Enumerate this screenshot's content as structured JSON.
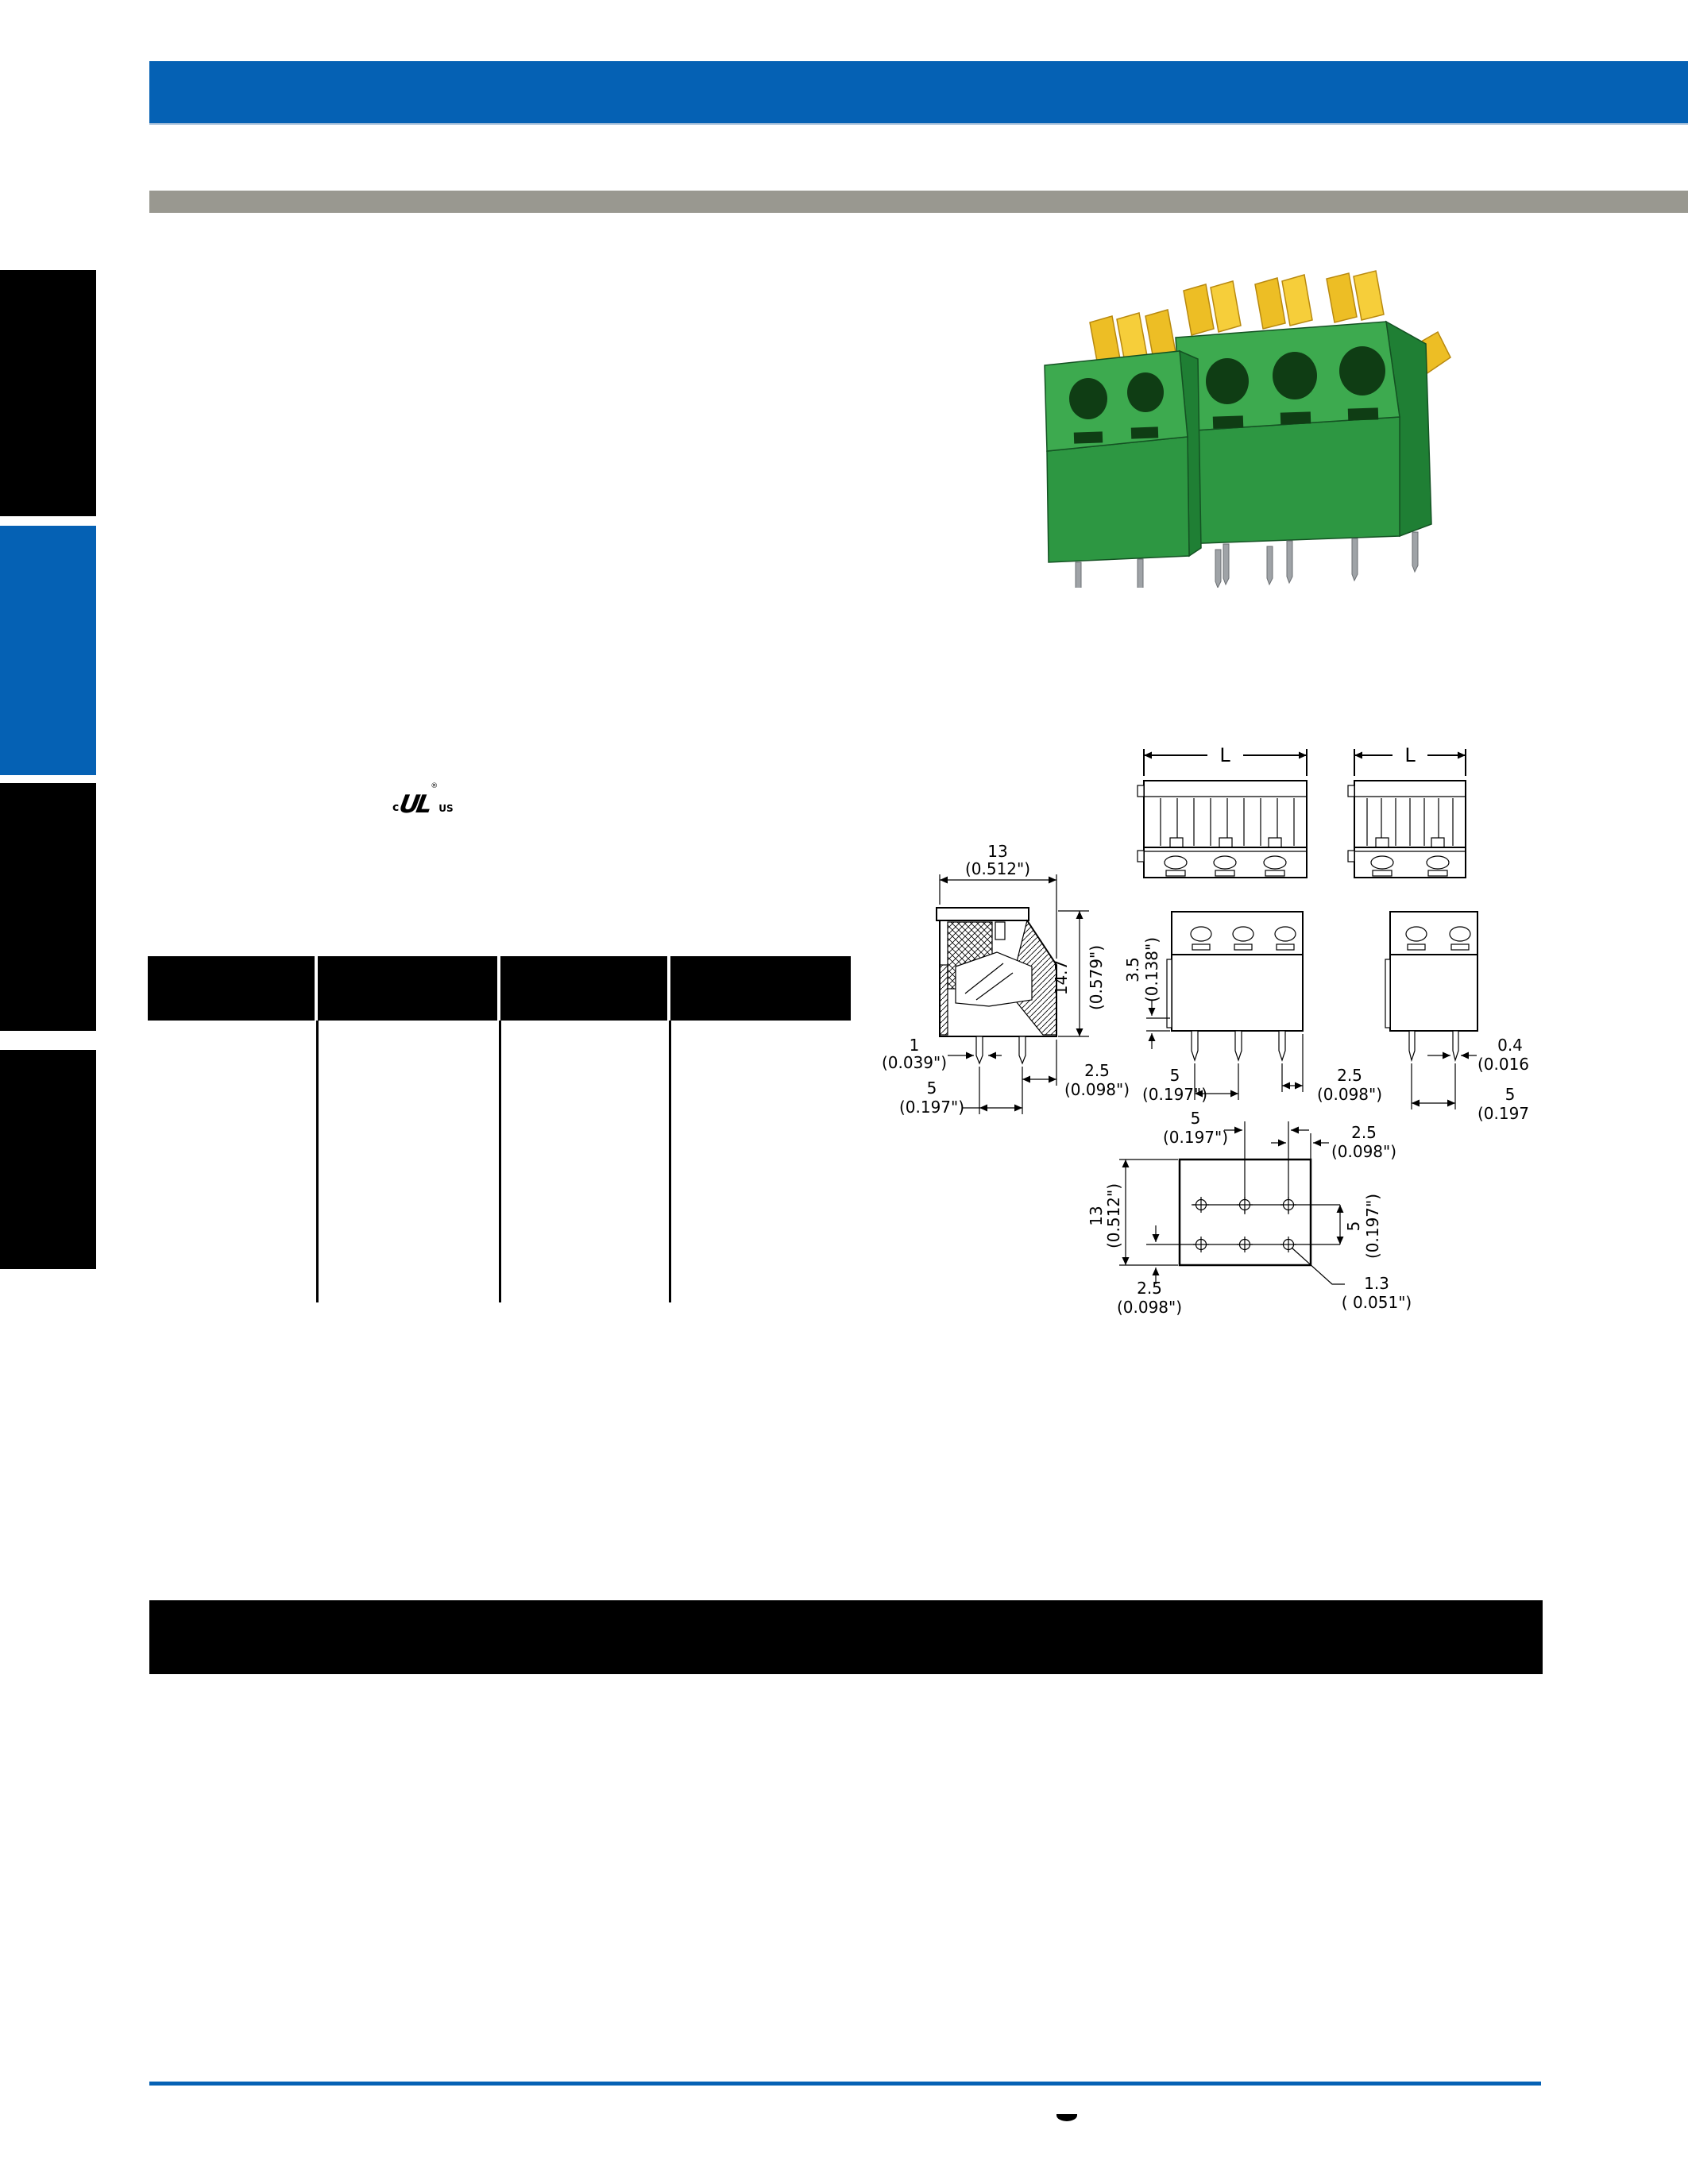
{
  "colors": {
    "accent_blue": "#0561B4",
    "subheader_gray": "#999890",
    "block_black": "#000000",
    "product_green": "#2D9742",
    "product_green_light": "#3DAA4F",
    "product_green_dark": "#1F7F34",
    "lever_yellow": "#EDBE25",
    "pin_gray": "#9FA3A7"
  },
  "certification": {
    "c": "c",
    "logo": "UL",
    "registered": "®",
    "us": "US"
  },
  "table": {
    "columns": [
      "",
      "",
      "",
      ""
    ]
  },
  "drawings": {
    "L": "L",
    "side_view": {
      "width": "13",
      "width_in": "(0.512\")",
      "height": "14.7",
      "height_in": "(0.579\")",
      "pin_width": "1",
      "pin_width_in": "(0.039\")",
      "pitch": "5",
      "pitch_in": "(0.197\")",
      "edge": "2.5",
      "edge_in": "(0.098\")"
    },
    "front_view_3pole": {
      "height": "3.5",
      "height_in": "(0.138\")",
      "pitch": "5",
      "pitch_in": "(0.197\")",
      "edge": "2.5",
      "edge_in": "(0.098\")"
    },
    "front_view_2pole": {
      "pin_width": "0.4",
      "pin_width_in": "(0.016\")",
      "pitch": "5",
      "pitch_in": "(0.197\")"
    },
    "pcb_layout": {
      "col_pitch": "5",
      "col_pitch_in": "(0.197\")",
      "edge_right": "2.5",
      "edge_right_in": "(0.098\")",
      "height": "13",
      "height_in": "(0.512\")",
      "edge_bottom": "2.5",
      "edge_bottom_in": "(0.098\")",
      "row_pitch": "5",
      "row_pitch_in": "(0.197\")",
      "hole_dia": "1.3",
      "hole_dia_in": "( 0.051\")"
    }
  }
}
